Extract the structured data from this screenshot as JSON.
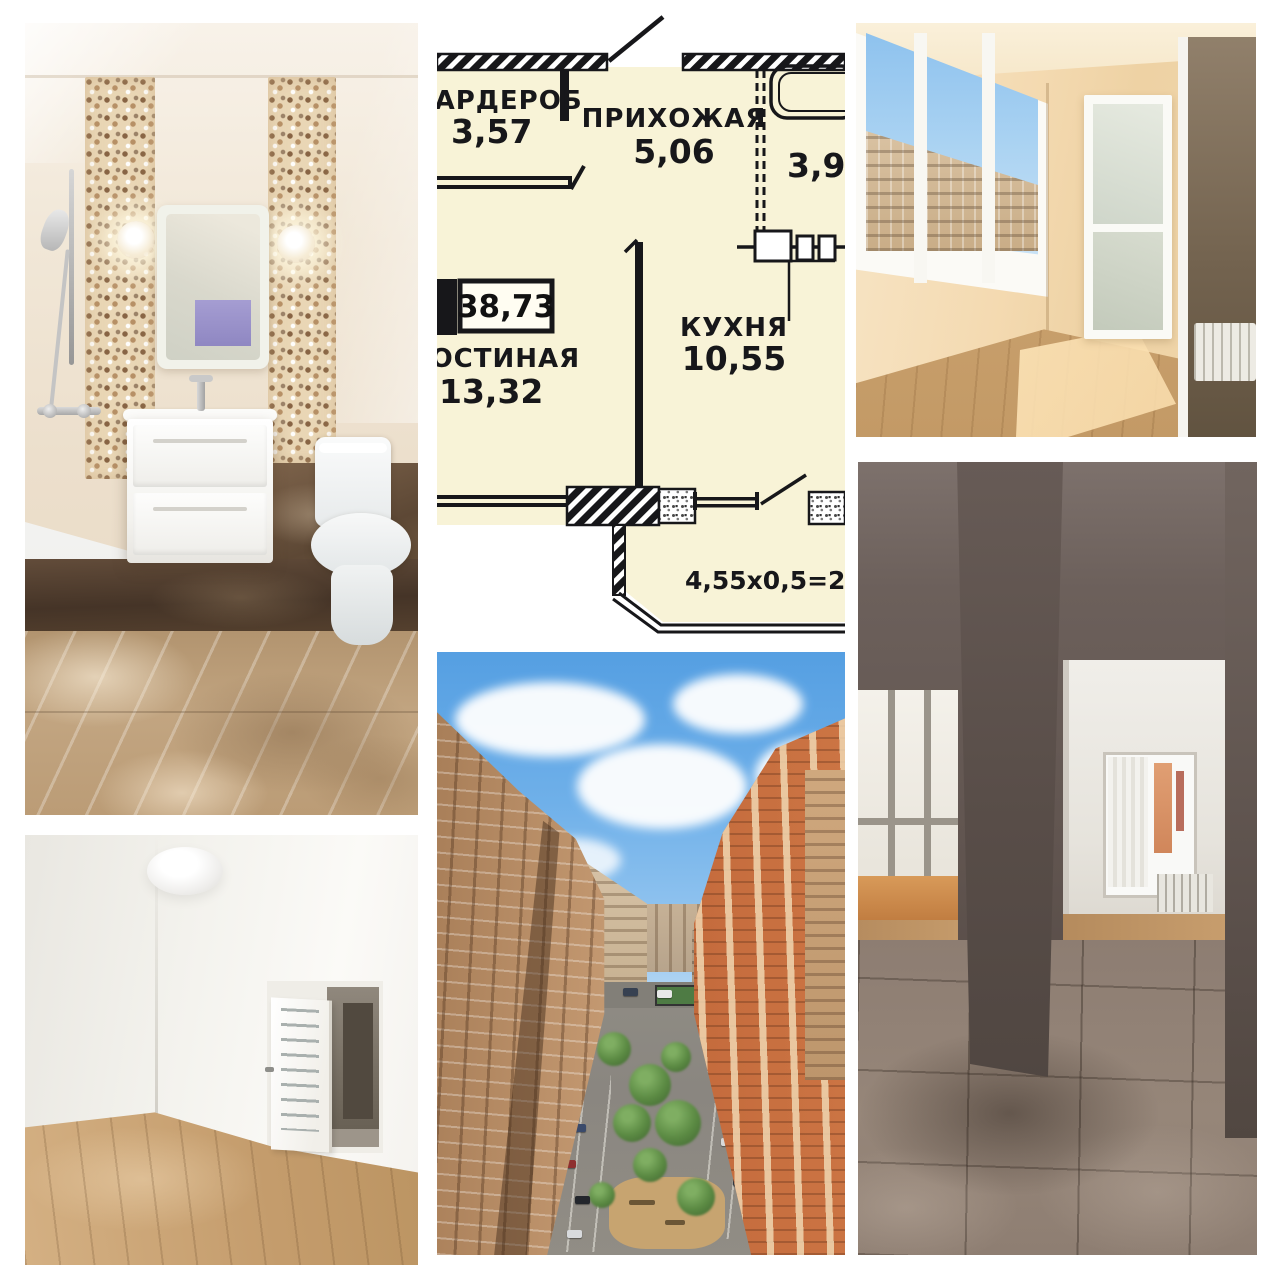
{
  "floor_plan": {
    "total_area": "38,73",
    "rooms": {
      "wardrobe": {
        "name": "ГАРДЕРОБ",
        "area": "3,57"
      },
      "hallway": {
        "name": "ПРИХОЖАЯ",
        "area": "5,06"
      },
      "bathroom": {
        "area": "3,95"
      },
      "living_room": {
        "name": "ГОСТИНАЯ",
        "area": "13,32"
      },
      "kitchen": {
        "name": "КУХНЯ",
        "area": "10,55"
      }
    },
    "balcony_formula": "4,55х0,5=2,28",
    "colors": {
      "plan_fill": "#f8f3d7",
      "wall": "#17171a",
      "background": "#ffffff"
    }
  }
}
